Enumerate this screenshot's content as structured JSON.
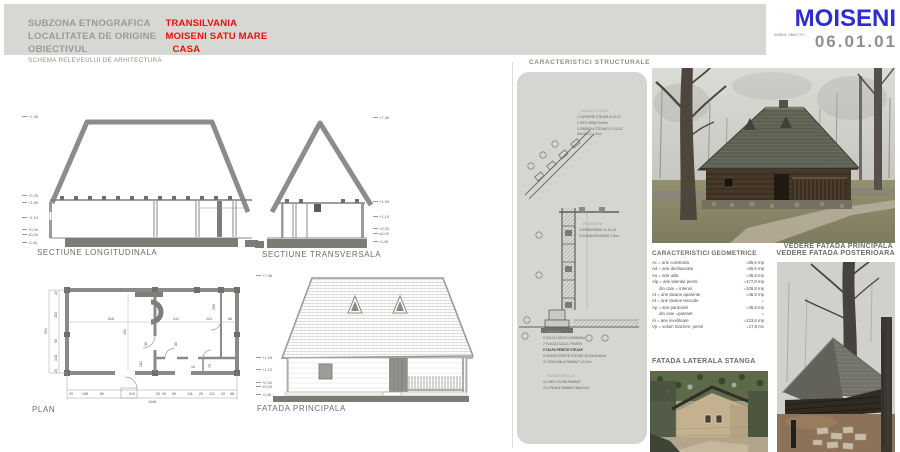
{
  "header": {
    "rows": [
      {
        "label": "SUBZONA ETNOGRAFICA",
        "value": "TRANSILVANIA"
      },
      {
        "label": "LOCALITATEA DE ORIGINE",
        "value": "MOISENI  SATU MARE"
      },
      {
        "label": "OBIECTIVUL",
        "value": "CASA"
      }
    ],
    "subtitle": "SCHEMA RELEVEULUI DE ARHITECTURA",
    "logo": {
      "title": "MOISENI",
      "symbol_label": "SIMBOL OBIECTIV",
      "code": "06.01.01"
    }
  },
  "colors": {
    "accent_red": "#e8100d",
    "logo_blue": "#2d2dd0",
    "band_gray": "#d7d7d4",
    "panel_gray": "#d5d5d2"
  },
  "drawings": {
    "longitudinala": {
      "title": "SECTIUNE LONGITUDINALA",
      "elevations": [
        "+7,36",
        "+2,25",
        "+1,95",
        "+1,10",
        "+0,30",
        "±0,00",
        "-0,45"
      ]
    },
    "transversala": {
      "title": "SECTIUNE TRANSVERSALA",
      "elevations": [
        "+7,36",
        "+1,95",
        "+1,10",
        "+0,30",
        "±0,00",
        "-0,45"
      ]
    },
    "plan": {
      "title": "PLAN",
      "dims_bottom": [
        "20",
        "148",
        "60",
        "310",
        "20",
        "40",
        "90",
        "111",
        "20",
        "121",
        "20",
        "68"
      ],
      "total_width": "1048",
      "dims_left": [
        "20",
        "283",
        "60",
        "148",
        "20"
      ],
      "total_height": "531",
      "dims_inner": {
        "a": "518",
        "b": "491",
        "c": "241",
        "d": "121",
        "e": "68",
        "f": "396",
        "g": "90",
        "h": "102",
        "i": "80",
        "j": "75",
        "k": "10"
      }
    },
    "fatada": {
      "title": "FATADA PRINCIPALA",
      "elevations": [
        "+7,36",
        "+1,95",
        "+1,10",
        "+0,30",
        "±0,00",
        "-0,45"
      ]
    }
  },
  "structural": {
    "title": "CARACTERISTICI STRUCTURALE",
    "invelitoare": {
      "name": "INVELITOARE",
      "items": [
        "1  CAPRIORI STEJAR Ø 10-12",
        "2  SIPCI BRAD 5x3cm",
        "3  SINDRILA STEJAR CU SCOC",
        "    80x10x1,2-1,5cm"
      ]
    },
    "planseu": {
      "name": "PLANSEU",
      "items": [
        "4  GRINZI BRAD 12-14-16",
        "5  SCANDURA BRAD 2,5cm"
      ]
    },
    "pereti": {
      "name": "PERETI",
      "items": [
        "6  SOCLU VECHI CARAMIDA",
        "7  PLACAJ SOCLU PIATRA",
        "8  TALPA PERETE STEJAR",
        "9  GRINZI PERETE STEJAR 15-20x40-60cm",
        "10  TENCUIALA PAMANT 1,5-2cm"
      ]
    },
    "pardoseala": {
      "name": "PARDOSEALA",
      "items": [
        "11  UMPLUTURA PAMANT",
        "12  LIPEALA PAMANT+BALEGA"
      ]
    }
  },
  "geometric": {
    "title": "CARACTERISTICI GEOMETRICE",
    "rows": [
      {
        "label": "Ac = arie construita",
        "value": "=55,6 mp"
      },
      {
        "label": "Ad = arie desfasurata",
        "value": "=55,6 mp"
      },
      {
        "label": "Au = arie utila",
        "value": "=45,9 mp"
      },
      {
        "label": "Alp = arie laterala pereti",
        "value": "=177,8 mp"
      },
      {
        "label": "      din care = interior",
        "value": "=106,8 mp"
      },
      {
        "label": "At = arie tavane aparente",
        "value": "=45,9 mp"
      },
      {
        "label": "At = arie tavane tencuite",
        "value": "="
      },
      {
        "label": "Ap = arie pardoseli",
        "value": "=45,9 mp"
      },
      {
        "label": "      din care =pamant",
        "value": "="
      },
      {
        "label": "Ai = arie invelitoare",
        "value": "=133,6 mp"
      },
      {
        "label": "Vp = volum mat.lem. pereti",
        "value": "=17,8 mc"
      }
    ]
  },
  "photos": {
    "principala": {
      "caption": "VEDERE  FATADA PRINCIPALA"
    },
    "posterioara": {
      "caption": "VEDERE  FATADA POSTERIOARA"
    },
    "laterala": {
      "caption": "FATADA LATERALA STANGA"
    }
  }
}
